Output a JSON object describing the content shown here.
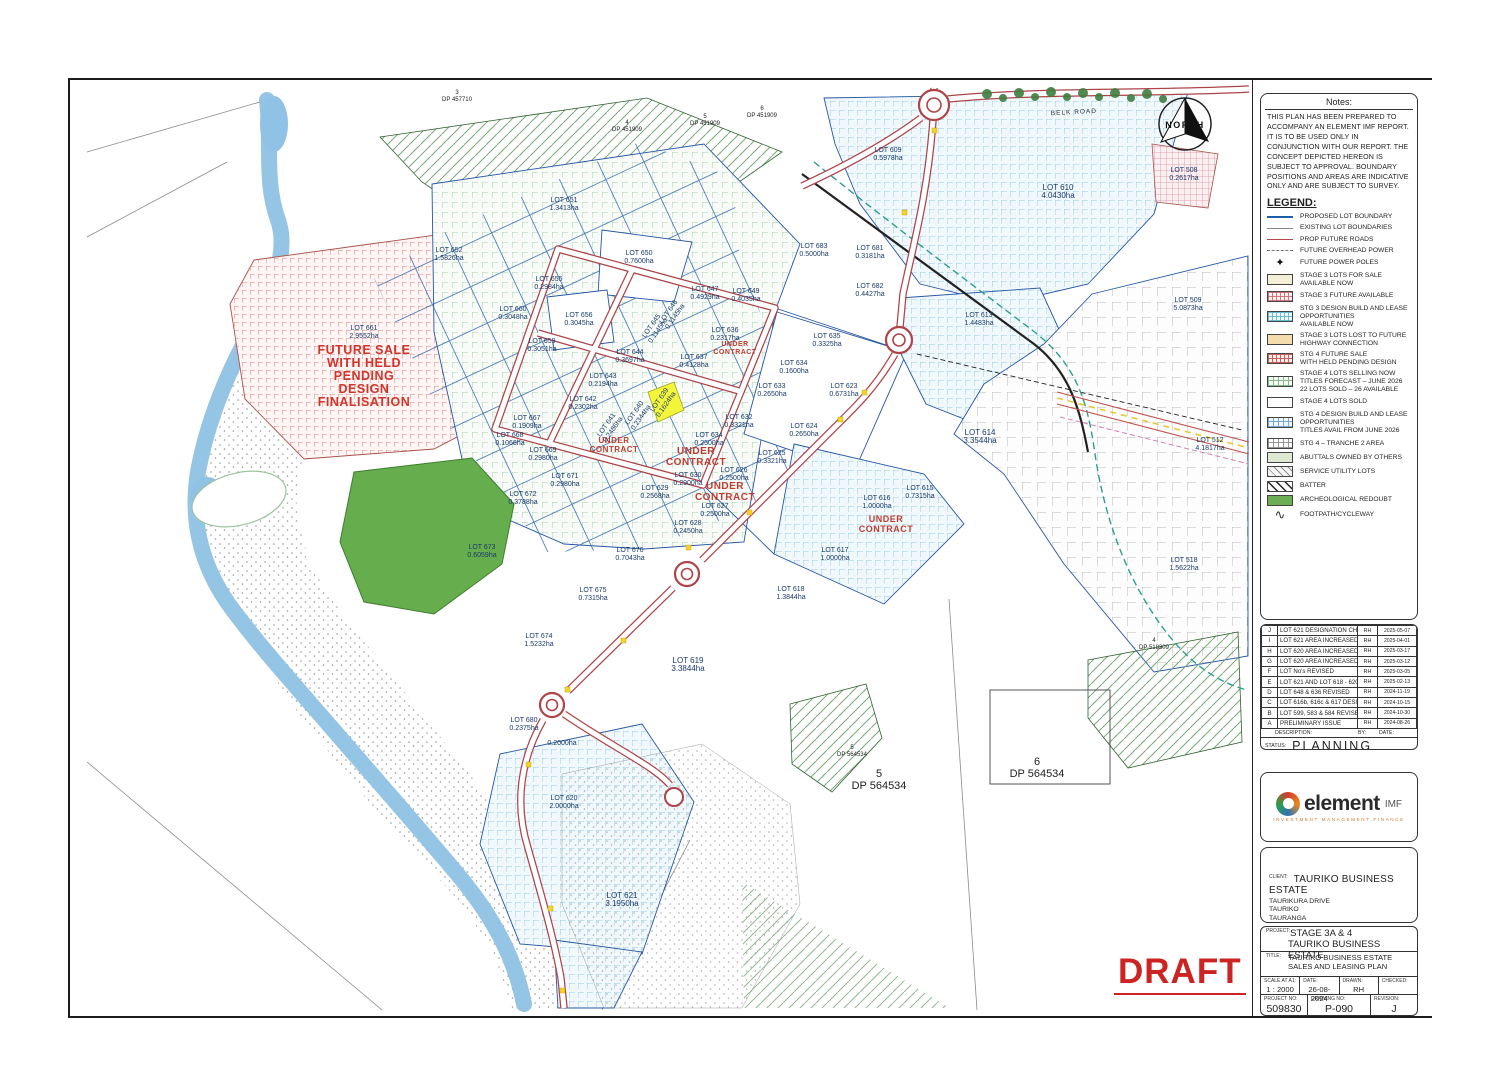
{
  "draft_label": "DRAFT",
  "panel": {
    "notes_title": "Notes:",
    "notes_body": "THIS PLAN HAS BEEN PREPARED TO ACCOMPANY AN ELEMENT IMF REPORT.  IT IS TO BE  USED ONLY IN CONJUNCTION WITH OUR REPORT.  THE CONCEPT DEPICTED HEREON IS SUBJECT  TO APPROVAL. BOUNDARY POSITIONS AND AREAS ARE INDICATIVE  ONLY AND ARE SUBJECT TO SURVEY.",
    "legend_title": "LEGEND:",
    "icons": {
      "power_pole": "✦",
      "footpath": "∿"
    },
    "legend": [
      {
        "type": "line-blue",
        "label": "PROPOSED LOT BOUNDARY"
      },
      {
        "type": "line-gray",
        "label": "EXISTING LOT BOUNDARIES"
      },
      {
        "type": "line-red",
        "label": "PROP FUTURE ROADS"
      },
      {
        "type": "line-dash",
        "label": "FUTURE OVERHEAD POWER"
      },
      {
        "type": "pole",
        "label": "FUTURE POWER POLES"
      },
      {
        "type": "cream",
        "label": "STAGE 3 LOTS FOR SALE\nAVAILABLE NOW"
      },
      {
        "type": "pinkhatch",
        "label": "STAGE 3 FUTURE AVAILABLE"
      },
      {
        "type": "cyanhatch",
        "label": "STG 3 DESIGN BUILD AND LEASE\nOPPORTUNITIES\nAVAILABLE NOW"
      },
      {
        "type": "tan",
        "label": "STAGE 3 LOTS LOST TO FUTURE\nHIGHWAY CONNECTION"
      },
      {
        "type": "redgrid",
        "label": "STG 4 FUTURE SALE\nWITH HELD PENDING DESIGN"
      },
      {
        "type": "greengrid",
        "label": "STAGE 4 LOTS SELLING NOW\nTITLES FORECAST – JUNE 2026\n22 LOTS SOLD – 26 AVAILABLE"
      },
      {
        "type": "white",
        "label": "STAGE 4 LOTS SOLD"
      },
      {
        "type": "bluegrid",
        "label": "STG 4 DESIGN BUILD AND LEASE\nOPPORTUNITIES\nTITLES AVAIL FROM JUNE 2026"
      },
      {
        "type": "graygrid",
        "label": "STG 4 – TRANCHE 2 AREA"
      },
      {
        "type": "sage",
        "label": "ABUTTALS OWNED BY OTHERS"
      },
      {
        "type": "grayhatch",
        "label": "SERVICE  UTILITY LOTS"
      },
      {
        "type": "blackhatch",
        "label": "BATTER"
      },
      {
        "type": "green",
        "label": "ARCHEOLOGICAL REDOUBT"
      },
      {
        "type": "squiggle",
        "label": "FOOTPATH/CYCLEWAY"
      }
    ],
    "revisions": [
      {
        "rev": "J",
        "desc": "LOT 621 DESIGNATION CHANGED",
        "by": "RH",
        "date": "2025-05-07"
      },
      {
        "rev": "I",
        "desc": "LOT 621 AREA INCREASED",
        "by": "RH",
        "date": "2025-04-01"
      },
      {
        "rev": "H",
        "desc": "LOT 620 AREA INCREASED",
        "by": "RH",
        "date": "2025-03-17"
      },
      {
        "rev": "G",
        "desc": "LOT 620 AREA INCREASED",
        "by": "RH",
        "date": "2025-03-12"
      },
      {
        "rev": "F",
        "desc": "LOT No's REVISED",
        "by": "RH",
        "date": "2025-03-05"
      },
      {
        "rev": "E",
        "desc": "LOT 621  AND LOT 618 - 620 REV",
        "by": "RH",
        "date": "2025-02-13"
      },
      {
        "rev": "D",
        "desc": "LOT 648 & 636 REVISED",
        "by": "RH",
        "date": "2024-11-19"
      },
      {
        "rev": "C",
        "desc": "LOT 616b, 616c & 617 DESIGNAT",
        "by": "RH",
        "date": "2024-10-15"
      },
      {
        "rev": "B",
        "desc": "LOT 599, 583 & 584 REVISED",
        "by": "RH",
        "date": "2024-10-30"
      },
      {
        "rev": "A",
        "desc": "PRELIMINARY ISSUE",
        "by": "RH",
        "date": "2024-08-26"
      }
    ],
    "rev_footer": {
      "desc": "DESCRIPTION:",
      "by": "BY:",
      "date": "DATE:"
    },
    "status_label": "STATUS:",
    "status_value": "PLANNING",
    "logo": {
      "brand": "element",
      "suffix": "IMF",
      "tagline": "INVESTMENT MANAGEMENT FINANCE"
    },
    "client": {
      "label": "CLIENT:",
      "name": "TAURIKO BUSINESS ESTATE",
      "lines": [
        "TAURIKURA DRIVE",
        "TAURIKO",
        "TAURANGA"
      ]
    },
    "project": {
      "label": "PROJECT:",
      "line1": "STAGE 3A & 4",
      "line2": "TAURIKO BUSINESS ESTATE"
    },
    "title": {
      "label": "TITLE:",
      "line1": "TAURIKO BUSINESS ESTATE",
      "line2": "SALES AND LEASING PLAN"
    },
    "scale": {
      "label": "SCALE  AT A1:",
      "value": "1 : 2000"
    },
    "date": {
      "label": "DATE:",
      "value": "26-08-2024"
    },
    "drawn": {
      "label": "DRAWN:",
      "value": "RH"
    },
    "checked": {
      "label": "CHECKED:",
      "value": ""
    },
    "project_no": {
      "label": "PROJECT  NO:",
      "value": "509830"
    },
    "drawing_no": {
      "label": "DRAWING  NO:",
      "value": "P-090"
    },
    "revision": {
      "label": "REVISION:",
      "value": "J"
    }
  },
  "map": {
    "labels": {
      "north": "NORTH",
      "belk_road": "BELK ROAD",
      "under_contract": [
        "UNDER",
        "CONTRACT"
      ],
      "future_sale": [
        "FUTURE SALE",
        "WITH HELD",
        "PENDING",
        "DESIGN",
        "FINALISATION"
      ]
    },
    "under_contract": [
      {
        "x": 733,
        "y": 344,
        "s": 7
      },
      {
        "x": 612,
        "y": 441,
        "s": 8
      },
      {
        "x": 694,
        "y": 452,
        "s": 10
      },
      {
        "x": 723,
        "y": 487,
        "s": 10
      },
      {
        "x": 884,
        "y": 520,
        "s": 9
      }
    ],
    "dp_labels": [
      {
        "num": "3",
        "dp": "DP 457710",
        "x": 455,
        "y": 92,
        "s": 6
      },
      {
        "num": "4",
        "dp": "DP 451909",
        "x": 625,
        "y": 122,
        "s": 6
      },
      {
        "num": "5",
        "dp": "DP 451909",
        "x": 703,
        "y": 116,
        "s": 6
      },
      {
        "num": "6",
        "dp": "DP 451909",
        "x": 760,
        "y": 108,
        "s": 6
      },
      {
        "num": "5",
        "dp": "DP 564534",
        "x": 850,
        "y": 747,
        "s": 6
      },
      {
        "num": "5",
        "dp": "DP 564534",
        "x": 877,
        "y": 775,
        "s": 11
      },
      {
        "num": "6",
        "dp": "DP 564534",
        "x": 1035,
        "y": 763,
        "s": 11
      },
      {
        "num": "4",
        "dp": "DP 518309",
        "x": 1152,
        "y": 640,
        "s": 6
      }
    ],
    "lots": [
      {
        "label": "LOT 651",
        "area": "1.3413ha",
        "x": 562,
        "y": 200
      },
      {
        "label": "LOT 652",
        "area": "1.5826ha",
        "x": 447,
        "y": 250
      },
      {
        "label": "LOT 650",
        "area": "0.7600ha",
        "x": 637,
        "y": 253
      },
      {
        "label": "LOT 655",
        "area": "0.2984ha",
        "x": 547,
        "y": 279
      },
      {
        "label": "LOT 660",
        "area": "0.3048ha",
        "x": 511,
        "y": 309
      },
      {
        "label": "LOT 656",
        "area": "0.3045ha",
        "x": 577,
        "y": 315
      },
      {
        "label": "LOT 659",
        "area": "0.3051ha",
        "x": 540,
        "y": 341
      },
      {
        "label": "LOT 647",
        "area": "0.4929ha",
        "x": 703,
        "y": 289
      },
      {
        "label": "LOT 649",
        "area": "0.4035ha",
        "x": 744,
        "y": 291
      },
      {
        "label": "LOT 646",
        "area": "0.1145ha",
        "x": 668,
        "y": 311,
        "rot": -55
      },
      {
        "label": "LOT 645",
        "area": "0.1145ha",
        "x": 651,
        "y": 325,
        "rot": -55
      },
      {
        "label": "LOT 636",
        "area": "0.2317ha",
        "x": 723,
        "y": 330
      },
      {
        "label": "LOT 644",
        "area": "0.3697ha",
        "x": 628,
        "y": 352
      },
      {
        "label": "LOT 637",
        "area": "0.4128ha",
        "x": 692,
        "y": 357
      },
      {
        "label": "LOT 643",
        "area": "0.2194ha",
        "x": 601,
        "y": 376
      },
      {
        "label": "LOT 642",
        "area": "0.2302ha",
        "x": 581,
        "y": 399
      },
      {
        "label": "LOT 640",
        "area": "0.2344ha",
        "x": 634,
        "y": 412,
        "rot": -55
      },
      {
        "label": "LOT 641",
        "area": "0.2486ha",
        "x": 606,
        "y": 424,
        "rot": -55
      },
      {
        "label": "LOT 639",
        "area": "0.1624ha",
        "x": 659,
        "y": 399,
        "rot": -55
      },
      {
        "label": "LOT 667",
        "area": "0.1909ha",
        "x": 525,
        "y": 418
      },
      {
        "label": "LOT 668",
        "area": "0.1066ha",
        "x": 508,
        "y": 435
      },
      {
        "label": "LOT 669",
        "area": "0.2980ha",
        "x": 541,
        "y": 450
      },
      {
        "label": "LOT 671",
        "area": "0.2980ha",
        "x": 563,
        "y": 476
      },
      {
        "label": "LOT 672",
        "area": "0.3788ha",
        "x": 521,
        "y": 494
      },
      {
        "label": "LOT 673",
        "area": "0.6059ha",
        "x": 480,
        "y": 547
      },
      {
        "label": "LOT 676",
        "area": "0.7043ha",
        "x": 628,
        "y": 550
      },
      {
        "label": "LOT 675",
        "area": "0.7315ha",
        "x": 591,
        "y": 590
      },
      {
        "label": "LOT 674",
        "area": "1.5232ha",
        "x": 537,
        "y": 636
      },
      {
        "label": "LOT 634",
        "area": "0.2500ha",
        "x": 707,
        "y": 435
      },
      {
        "label": "LOT 632",
        "area": "0.3321ha",
        "x": 737,
        "y": 417
      },
      {
        "label": "LOT 624",
        "area": "0.2650ha",
        "x": 802,
        "y": 426
      },
      {
        "label": "LOT 625",
        "area": "0.3321ha",
        "x": 770,
        "y": 453
      },
      {
        "label": "LOT 626",
        "area": "0.2500ha",
        "x": 732,
        "y": 470
      },
      {
        "label": "LOT 630",
        "area": "0.2900ha",
        "x": 686,
        "y": 475
      },
      {
        "label": "LOT 629",
        "area": "0.2568ha",
        "x": 653,
        "y": 488
      },
      {
        "label": "LOT 627",
        "area": "0.2500ha",
        "x": 713,
        "y": 506
      },
      {
        "label": "LOT 628",
        "area": "0.2450ha",
        "x": 686,
        "y": 523
      },
      {
        "label": "LOT 635",
        "area": "0.3325ha",
        "x": 825,
        "y": 336
      },
      {
        "label": "LOT 634",
        "area": "0.1600ha",
        "x": 792,
        "y": 363
      },
      {
        "label": "LOT 633",
        "area": "0.2650ha",
        "x": 770,
        "y": 386
      },
      {
        "label": "LOT 623",
        "area": "0.6731ha",
        "x": 842,
        "y": 386
      },
      {
        "label": "LOT 683",
        "area": "0.5000ha",
        "x": 812,
        "y": 246
      },
      {
        "label": "LOT 681",
        "area": "0.3181ha",
        "x": 868,
        "y": 248
      },
      {
        "label": "LOT 682",
        "area": "0.4427ha",
        "x": 868,
        "y": 286
      },
      {
        "label": "LOT 613",
        "area": "1.4483ha",
        "x": 977,
        "y": 315
      },
      {
        "label": "LOT 614",
        "area": "3.3544ha",
        "x": 978,
        "y": 433,
        "s": 8
      },
      {
        "label": "LOT 615",
        "area": "0.7315ha",
        "x": 918,
        "y": 488
      },
      {
        "label": "LOT 616",
        "area": "1.0000ha",
        "x": 875,
        "y": 498
      },
      {
        "label": "LOT 617",
        "area": "1.0000ha",
        "x": 833,
        "y": 550
      },
      {
        "label": "LOT 618",
        "area": "1.3844ha",
        "x": 789,
        "y": 589
      },
      {
        "label": "LOT 619",
        "area": "3.3844ha",
        "x": 686,
        "y": 661,
        "s": 8
      },
      {
        "label": "LOT 609",
        "area": "0.5978ha",
        "x": 886,
        "y": 150
      },
      {
        "label": "LOT 610",
        "area": "4.0430ha",
        "x": 1056,
        "y": 188,
        "s": 8
      },
      {
        "label": "LOT 508",
        "area": "0.2617ha",
        "x": 1182,
        "y": 170
      },
      {
        "label": "LOT 509",
        "area": "5.0873ha",
        "x": 1186,
        "y": 300
      },
      {
        "label": "LOT 512",
        "area": "4.1817ha",
        "x": 1208,
        "y": 440
      },
      {
        "label": "LOT 518",
        "area": "1.5622ha",
        "x": 1182,
        "y": 560
      },
      {
        "label": "LOT 661",
        "area": "2.9552ha",
        "x": 362,
        "y": 328
      },
      {
        "label": "LOT 680",
        "area": "0.2375ha",
        "x": 522,
        "y": 720
      },
      {
        "label": "",
        "area": "0.2000ha",
        "x": 560,
        "y": 743
      },
      {
        "label": "LOT 620",
        "area": "2.0000ha",
        "x": 562,
        "y": 798
      },
      {
        "label": "LOT 621",
        "area": "3.1950ha",
        "x": 620,
        "y": 896,
        "s": 8
      }
    ]
  }
}
